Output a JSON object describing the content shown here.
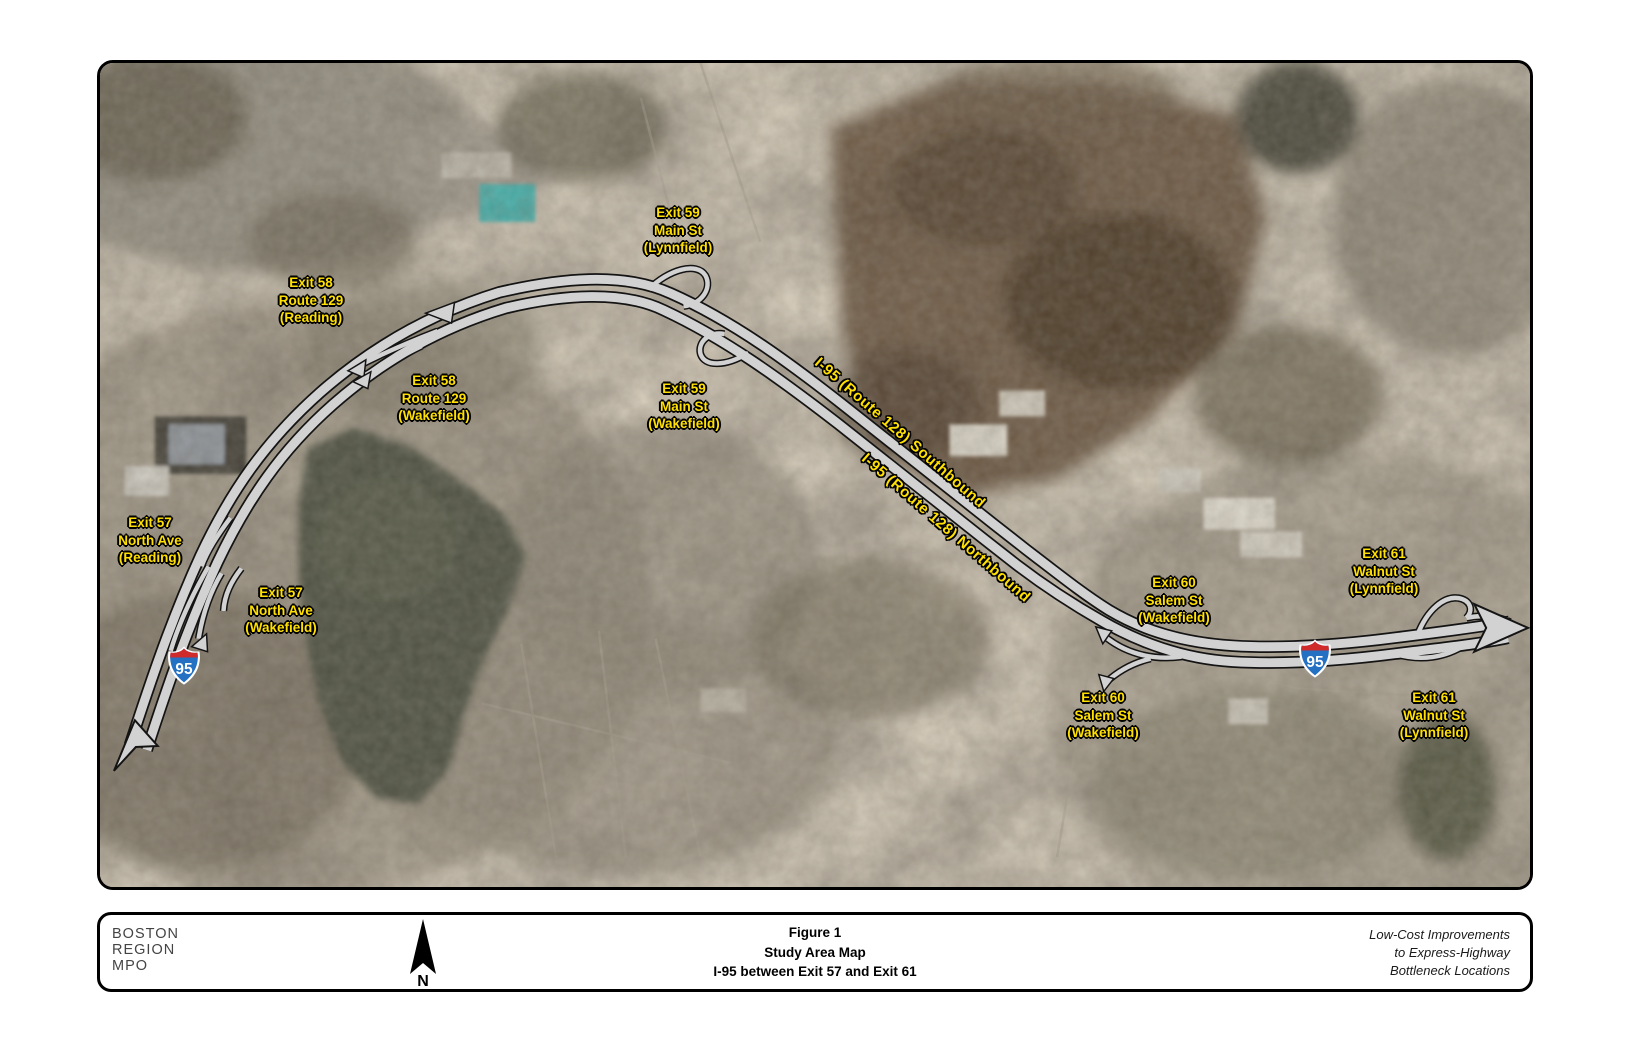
{
  "map": {
    "label_color": "#ffe000",
    "road_fill": "#d2d2d2",
    "road_casing": "#141414",
    "shield_red": "#cf2b2b",
    "shield_blue": "#2470c2",
    "route_labels": [
      {
        "text": "I-95 (Route 128) Southbound",
        "x": 900,
        "y": 433,
        "angle": 41
      },
      {
        "text": "I-95 (Route 128) Northbound",
        "x": 946,
        "y": 528,
        "angle": 41
      }
    ],
    "exit_labels": [
      {
        "lines": [
          "Exit 59",
          "Main St",
          "(Lynnfield)"
        ],
        "x": 678,
        "y": 230
      },
      {
        "lines": [
          "Exit 58",
          "Route 129",
          "(Reading)"
        ],
        "x": 311,
        "y": 300
      },
      {
        "lines": [
          "Exit 58",
          "Route 129",
          "(Wakefield)"
        ],
        "x": 434,
        "y": 398
      },
      {
        "lines": [
          "Exit 59",
          "Main St",
          "(Wakefield)"
        ],
        "x": 684,
        "y": 406
      },
      {
        "lines": [
          "Exit 57",
          "North Ave",
          "(Reading)"
        ],
        "x": 150,
        "y": 540
      },
      {
        "lines": [
          "Exit 57",
          "North Ave",
          "(Wakefield)"
        ],
        "x": 281,
        "y": 610
      },
      {
        "lines": [
          "Exit 60",
          "Salem St",
          "(Wakefield)"
        ],
        "x": 1174,
        "y": 600
      },
      {
        "lines": [
          "Exit 60",
          "Salem St",
          "(Wakefield)"
        ],
        "x": 1103,
        "y": 715
      },
      {
        "lines": [
          "Exit 61",
          "Walnut St",
          "(Lynnfield)"
        ],
        "x": 1384,
        "y": 571
      },
      {
        "lines": [
          "Exit 61",
          "Walnut St",
          "(Lynnfield)"
        ],
        "x": 1434,
        "y": 715
      }
    ],
    "shields": [
      {
        "number": "95",
        "x": 184,
        "y": 668
      },
      {
        "number": "95",
        "x": 1315,
        "y": 661
      }
    ]
  },
  "footer": {
    "org_lines": [
      "BOSTON",
      "REGION",
      "MPO"
    ],
    "north_label": "N",
    "title_lines": [
      "Figure 1",
      "Study Area Map",
      "I-95 between Exit 57 and Exit 61"
    ],
    "note_lines": [
      "Low-Cost Improvements",
      "to Express-Highway",
      "Bottleneck Locations"
    ]
  }
}
